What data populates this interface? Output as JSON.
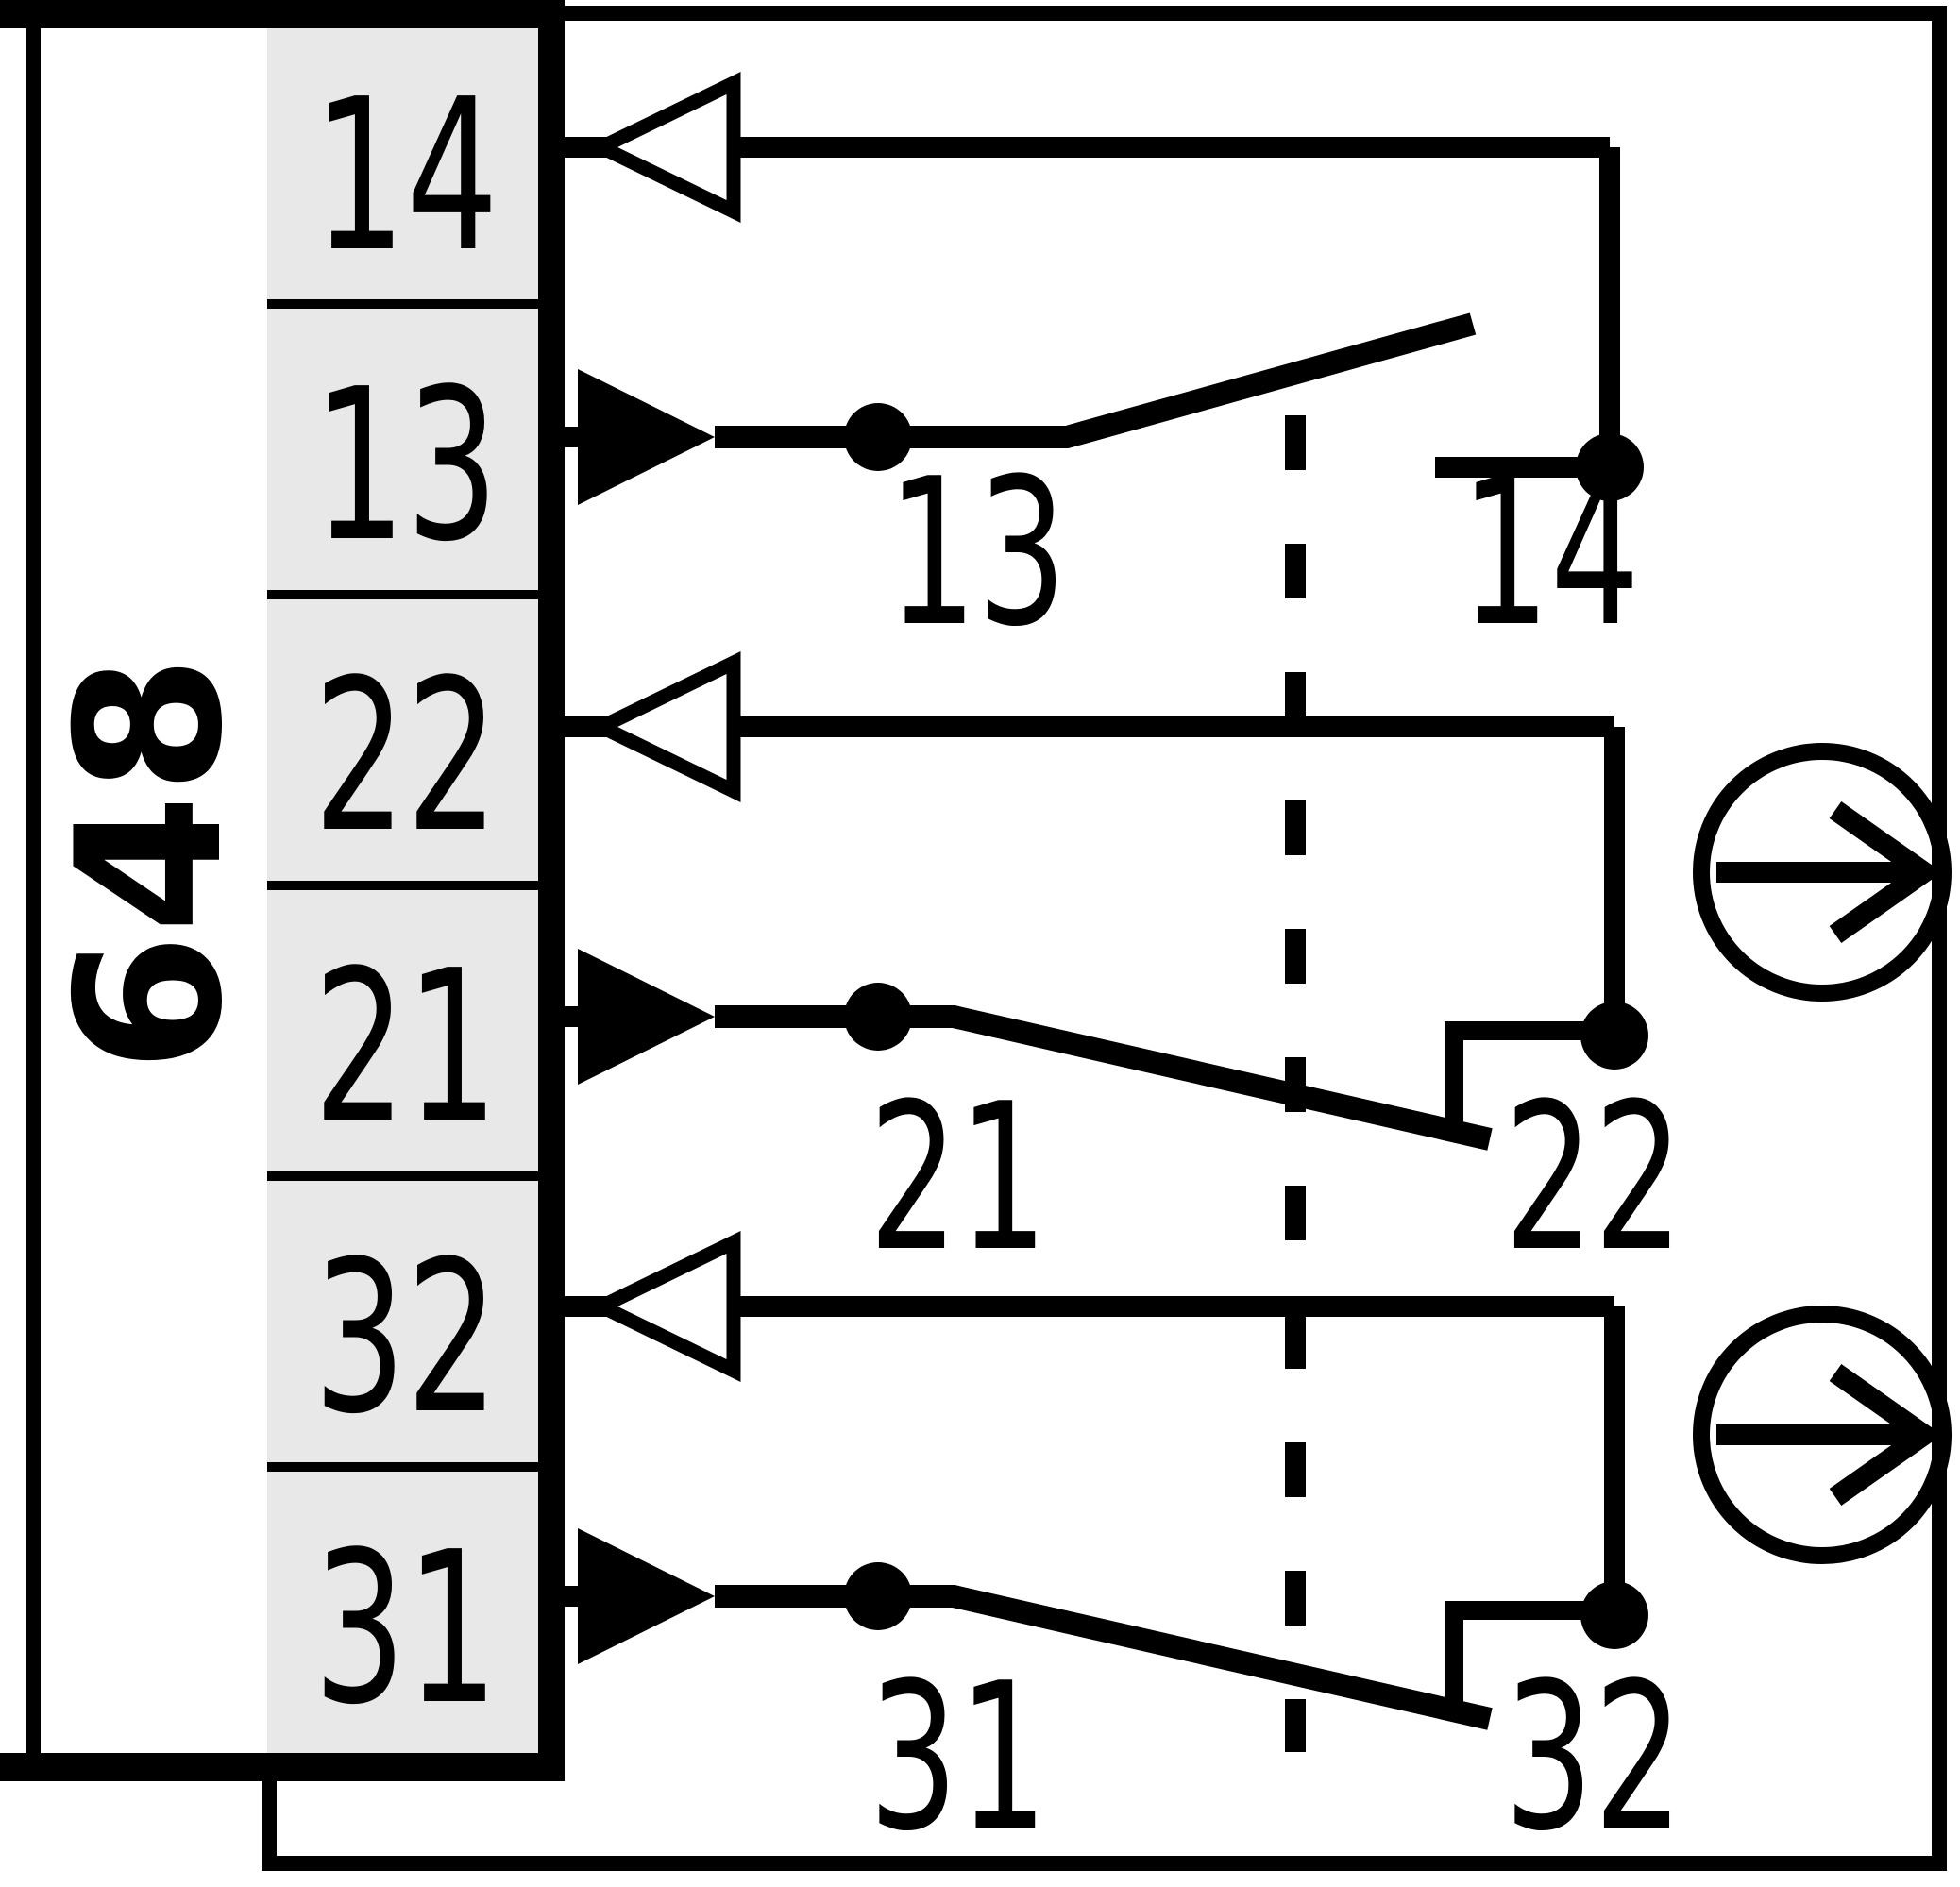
{
  "model_label": "648",
  "colors": {
    "line_black": "#000000",
    "terminal_cell_gray": "#e8e8e8",
    "background": "#ffffff"
  },
  "terminal_strip": {
    "terminals": [
      {
        "label": "14"
      },
      {
        "label": "13"
      },
      {
        "label": "22"
      },
      {
        "label": "21"
      },
      {
        "label": "32"
      },
      {
        "label": "31"
      }
    ]
  },
  "contacts": {
    "no_13_14": {
      "left_label": "13",
      "right_label": "14"
    },
    "nc_21_22": {
      "left_label": "21",
      "right_label": "22"
    },
    "nc_31_32": {
      "left_label": "31",
      "right_label": "32"
    }
  },
  "symbols": {
    "outgoing_arrow": "open-left-triangle",
    "incoming_arrow": "filled-right-triangle",
    "actuation_direction": "circle-with-right-arrow",
    "actuator_travel": "vertical-dashed-line"
  }
}
